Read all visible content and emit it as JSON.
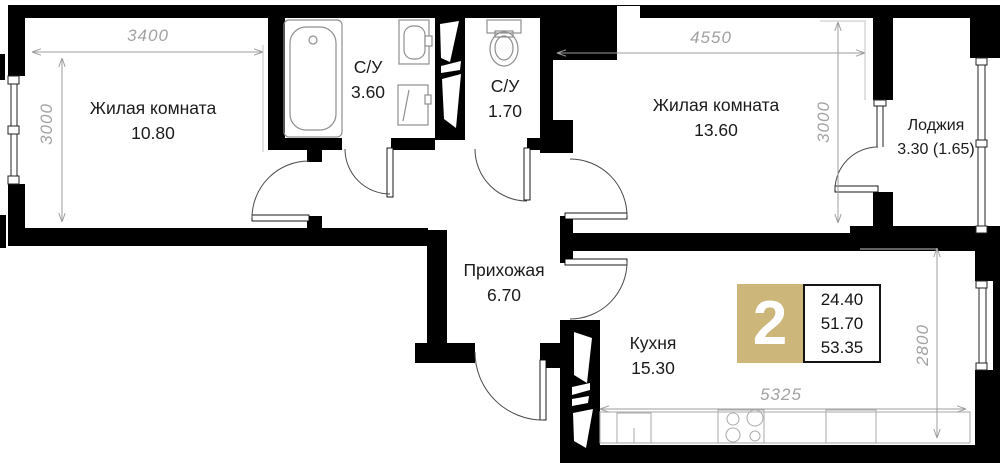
{
  "rooms": {
    "living1": {
      "label": "Жилая комната",
      "area": "10.80"
    },
    "bath1": {
      "label": "С/У",
      "area": "3.60"
    },
    "bath2": {
      "label": "С/У",
      "area": "1.70"
    },
    "living2": {
      "label": "Жилая комната",
      "area": "13.60"
    },
    "loggia": {
      "label": "Лоджия",
      "area": "3.30 (1.65)"
    },
    "hall": {
      "label": "Прихожая",
      "area": "6.70"
    },
    "kitchen": {
      "label": "Кухня",
      "area": "15.30"
    }
  },
  "dimensions": {
    "room1_width": "3400",
    "room1_height": "3000",
    "room2_width": "4550",
    "room2_height": "3000",
    "kitchen_height": "2800",
    "kitchen_width": "5325"
  },
  "badge": {
    "rooms_count": "2",
    "area_living": "24.40",
    "area_main": "51.70",
    "area_total": "53.35",
    "color": "#ccb67a"
  },
  "colors": {
    "wall": "#000000",
    "dim": "#9e9e9e",
    "text": "#1b1b1b"
  }
}
